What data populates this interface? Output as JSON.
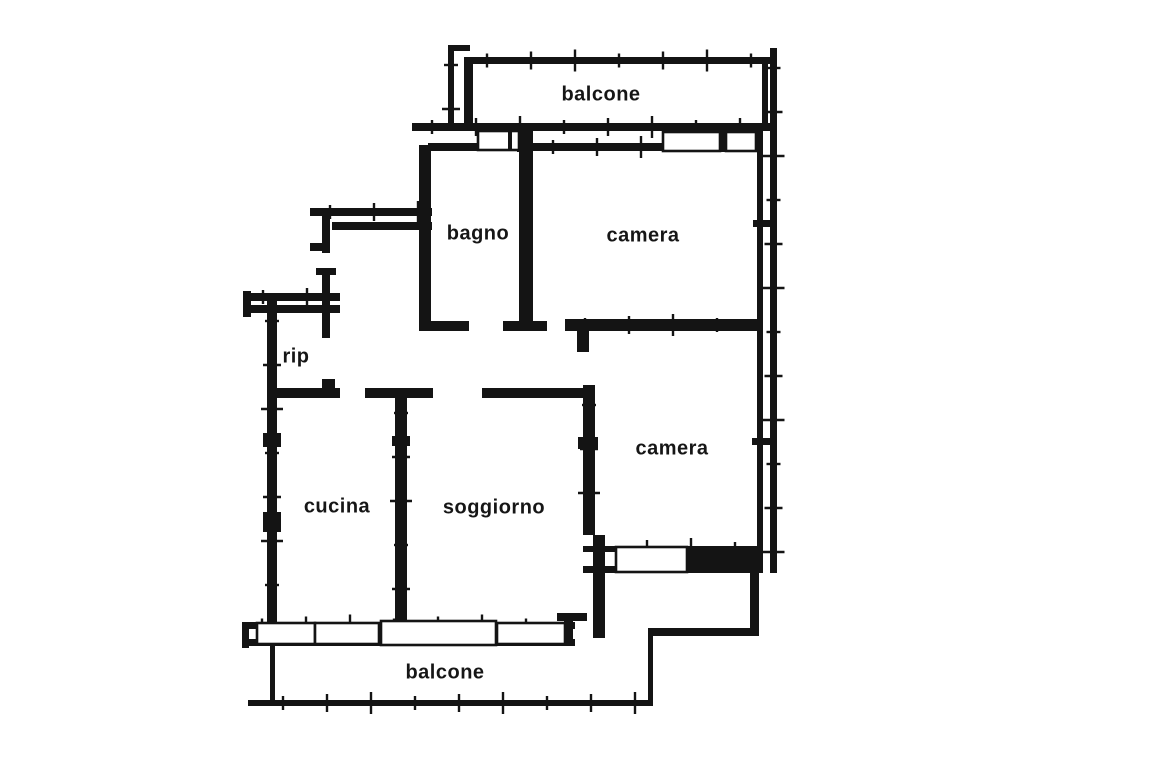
{
  "meta": {
    "document_type": "apartment floor plan (scanned)",
    "background_color": "#ffffff",
    "ink_color": "#141414",
    "label_color": "#161616",
    "label_font_size": 20
  },
  "plan": {
    "labels": [
      {
        "id": "balcone-top",
        "text": "balcone",
        "x": 601,
        "y": 95
      },
      {
        "id": "bagno",
        "text": "bagno",
        "x": 478,
        "y": 234
      },
      {
        "id": "camera-top",
        "text": "camera",
        "x": 643,
        "y": 236
      },
      {
        "id": "rip",
        "text": "rip",
        "x": 296,
        "y": 357
      },
      {
        "id": "camera-bottom",
        "text": "camera",
        "x": 672,
        "y": 449
      },
      {
        "id": "cucina",
        "text": "cucina",
        "x": 337,
        "y": 507
      },
      {
        "id": "soggiorno",
        "text": "soggiorno",
        "x": 494,
        "y": 508
      },
      {
        "id": "balcone-bottom",
        "text": "balcone",
        "x": 445,
        "y": 673
      }
    ],
    "walls": [
      {
        "x": 448,
        "y": 45,
        "w": 6,
        "h": 83,
        "ticks": "v"
      },
      {
        "x": 448,
        "y": 45,
        "w": 22,
        "h": 6,
        "ticks": null
      },
      {
        "x": 464,
        "y": 57,
        "w": 9,
        "h": 71,
        "ticks": null
      },
      {
        "x": 467,
        "y": 57,
        "w": 303,
        "h": 7,
        "ticks": "h"
      },
      {
        "x": 770,
        "y": 48,
        "w": 7,
        "h": 525,
        "ticks": "v"
      },
      {
        "x": 762,
        "y": 57,
        "w": 6,
        "h": 66,
        "ticks": null
      },
      {
        "x": 757,
        "y": 123,
        "w": 6,
        "h": 450,
        "ticks": null
      },
      {
        "x": 412,
        "y": 123,
        "w": 358,
        "h": 8,
        "ticks": "h"
      },
      {
        "x": 428,
        "y": 143,
        "w": 52,
        "h": 8,
        "ticks": null
      },
      {
        "x": 517,
        "y": 131,
        "w": 16,
        "h": 21,
        "ticks": null
      },
      {
        "x": 533,
        "y": 143,
        "w": 132,
        "h": 8,
        "ticks": "h"
      },
      {
        "x": 718,
        "y": 131,
        "w": 10,
        "h": 21,
        "ticks": null
      },
      {
        "x": 753,
        "y": 131,
        "w": 6,
        "h": 21,
        "ticks": null
      },
      {
        "x": 419,
        "y": 145,
        "w": 12,
        "h": 185,
        "ticks": null
      },
      {
        "x": 419,
        "y": 321,
        "w": 50,
        "h": 10,
        "ticks": null
      },
      {
        "x": 519,
        "y": 150,
        "w": 14,
        "h": 172,
        "ticks": null
      },
      {
        "x": 503,
        "y": 321,
        "w": 44,
        "h": 10,
        "ticks": null
      },
      {
        "x": 565,
        "y": 319,
        "w": 192,
        "h": 12,
        "ticks": "h"
      },
      {
        "x": 577,
        "y": 331,
        "w": 12,
        "h": 21,
        "ticks": null
      },
      {
        "x": 753,
        "y": 220,
        "w": 17,
        "h": 7,
        "ticks": null
      },
      {
        "x": 752,
        "y": 438,
        "w": 18,
        "h": 7,
        "ticks": null
      },
      {
        "x": 310,
        "y": 208,
        "w": 122,
        "h": 8,
        "ticks": "h"
      },
      {
        "x": 332,
        "y": 222,
        "w": 100,
        "h": 8,
        "ticks": null
      },
      {
        "x": 322,
        "y": 208,
        "w": 8,
        "h": 45,
        "ticks": null
      },
      {
        "x": 310,
        "y": 243,
        "w": 14,
        "h": 8,
        "ticks": null
      },
      {
        "x": 322,
        "y": 268,
        "w": 8,
        "h": 70,
        "ticks": null
      },
      {
        "x": 316,
        "y": 268,
        "w": 20,
        "h": 7,
        "ticks": null
      },
      {
        "x": 243,
        "y": 291,
        "w": 8,
        "h": 26,
        "ticks": null
      },
      {
        "x": 243,
        "y": 293,
        "w": 97,
        "h": 8,
        "ticks": "h"
      },
      {
        "x": 250,
        "y": 305,
        "w": 90,
        "h": 8,
        "ticks": null
      },
      {
        "x": 267,
        "y": 301,
        "w": 10,
        "h": 345,
        "ticks": "v"
      },
      {
        "x": 263,
        "y": 433,
        "w": 18,
        "h": 14,
        "ticks": null
      },
      {
        "x": 263,
        "y": 512,
        "w": 18,
        "h": 20,
        "ticks": null
      },
      {
        "x": 267,
        "y": 388,
        "w": 73,
        "h": 10,
        "ticks": null
      },
      {
        "x": 322,
        "y": 379,
        "w": 13,
        "h": 9,
        "ticks": null
      },
      {
        "x": 365,
        "y": 388,
        "w": 68,
        "h": 10,
        "ticks": null
      },
      {
        "x": 482,
        "y": 388,
        "w": 101,
        "h": 10,
        "ticks": null
      },
      {
        "x": 395,
        "y": 393,
        "w": 12,
        "h": 229,
        "ticks": "v"
      },
      {
        "x": 392,
        "y": 436,
        "w": 18,
        "h": 10,
        "ticks": null
      },
      {
        "x": 397,
        "y": 614,
        "w": 10,
        "h": 8,
        "ticks": null
      },
      {
        "x": 583,
        "y": 385,
        "w": 12,
        "h": 150,
        "ticks": "v"
      },
      {
        "x": 578,
        "y": 437,
        "w": 20,
        "h": 12,
        "ticks": null
      },
      {
        "x": 593,
        "y": 535,
        "w": 12,
        "h": 103,
        "ticks": null
      },
      {
        "x": 242,
        "y": 622,
        "w": 7,
        "h": 26,
        "ticks": null
      },
      {
        "x": 242,
        "y": 622,
        "w": 333,
        "h": 7,
        "ticks": "h"
      },
      {
        "x": 242,
        "y": 639,
        "w": 333,
        "h": 7,
        "ticks": null
      },
      {
        "x": 557,
        "y": 613,
        "w": 30,
        "h": 8,
        "ticks": null
      },
      {
        "x": 564,
        "y": 613,
        "w": 9,
        "h": 30,
        "ticks": null
      },
      {
        "x": 270,
        "y": 646,
        "w": 5,
        "h": 60,
        "ticks": null
      },
      {
        "x": 248,
        "y": 700,
        "w": 18,
        "h": 6,
        "ticks": null
      },
      {
        "x": 263,
        "y": 700,
        "w": 390,
        "h": 6,
        "ticks": "h"
      },
      {
        "x": 648,
        "y": 630,
        "w": 5,
        "h": 76,
        "ticks": null
      },
      {
        "x": 648,
        "y": 628,
        "w": 111,
        "h": 8,
        "ticks": null
      },
      {
        "x": 750,
        "y": 571,
        "w": 9,
        "h": 60,
        "ticks": null
      },
      {
        "x": 583,
        "y": 546,
        "w": 174,
        "h": 6,
        "ticks": "h"
      },
      {
        "x": 583,
        "y": 566,
        "w": 174,
        "h": 7,
        "ticks": null
      },
      {
        "x": 687,
        "y": 546,
        "w": 70,
        "h": 27,
        "ticks": null
      }
    ],
    "windows": [
      {
        "x": 478,
        "y": 131,
        "w": 41,
        "h": 19,
        "mullions": [
          510
        ]
      },
      {
        "x": 663,
        "y": 132,
        "w": 57,
        "h": 19,
        "mullions": []
      },
      {
        "x": 726,
        "y": 132,
        "w": 30,
        "h": 19,
        "mullions": []
      },
      {
        "x": 616,
        "y": 547,
        "w": 71,
        "h": 25,
        "mullions": []
      },
      {
        "x": 257,
        "y": 623,
        "w": 58,
        "h": 21,
        "mullions": []
      },
      {
        "x": 315,
        "y": 623,
        "w": 64,
        "h": 21,
        "mullions": []
      },
      {
        "x": 381,
        "y": 621,
        "w": 115,
        "h": 24,
        "mullions": []
      },
      {
        "x": 497,
        "y": 623,
        "w": 68,
        "h": 21,
        "mullions": []
      }
    ]
  }
}
